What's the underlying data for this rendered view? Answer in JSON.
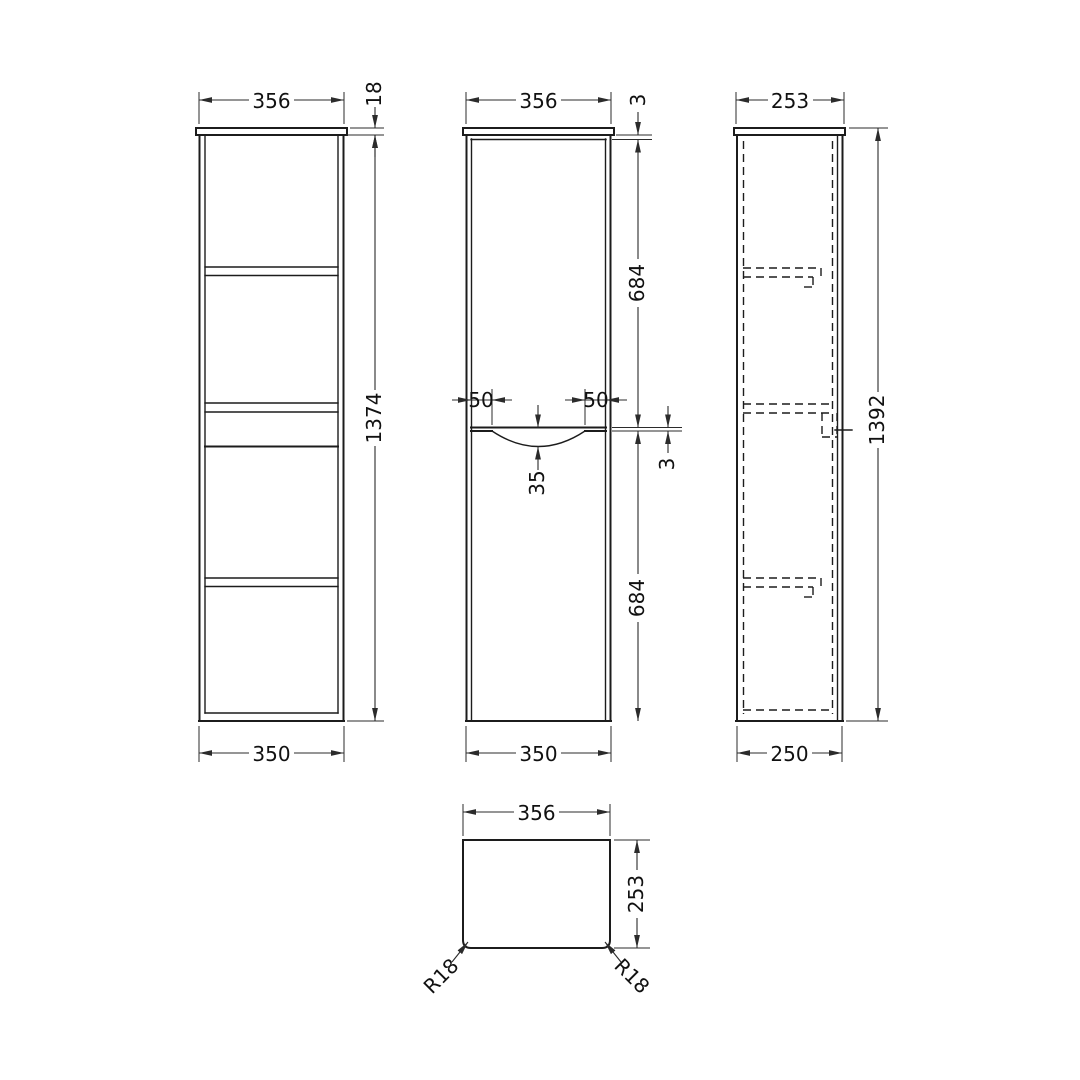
{
  "drawing": {
    "background": "#ffffff",
    "line_color": "#1c1c1c",
    "views": {
      "front_open": {
        "dims": {
          "width_top": "356",
          "top_thickness": "18",
          "height": "1374",
          "width_bottom": "350"
        }
      },
      "front_doors": {
        "dims": {
          "width_top": "356",
          "gap_top": "3",
          "upper_door_height": "684",
          "handle_inset_left": "50",
          "handle_inset_right": "50",
          "handle_recess_depth": "35",
          "door_gap": "3",
          "lower_door_height": "684",
          "width_bottom": "350"
        }
      },
      "side": {
        "dims": {
          "depth_top": "253",
          "height_overall": "1392",
          "depth_bottom": "250"
        }
      },
      "plan": {
        "dims": {
          "width": "356",
          "depth": "253",
          "radius_front_left": "R18",
          "radius_front_right": "R18"
        }
      }
    }
  }
}
